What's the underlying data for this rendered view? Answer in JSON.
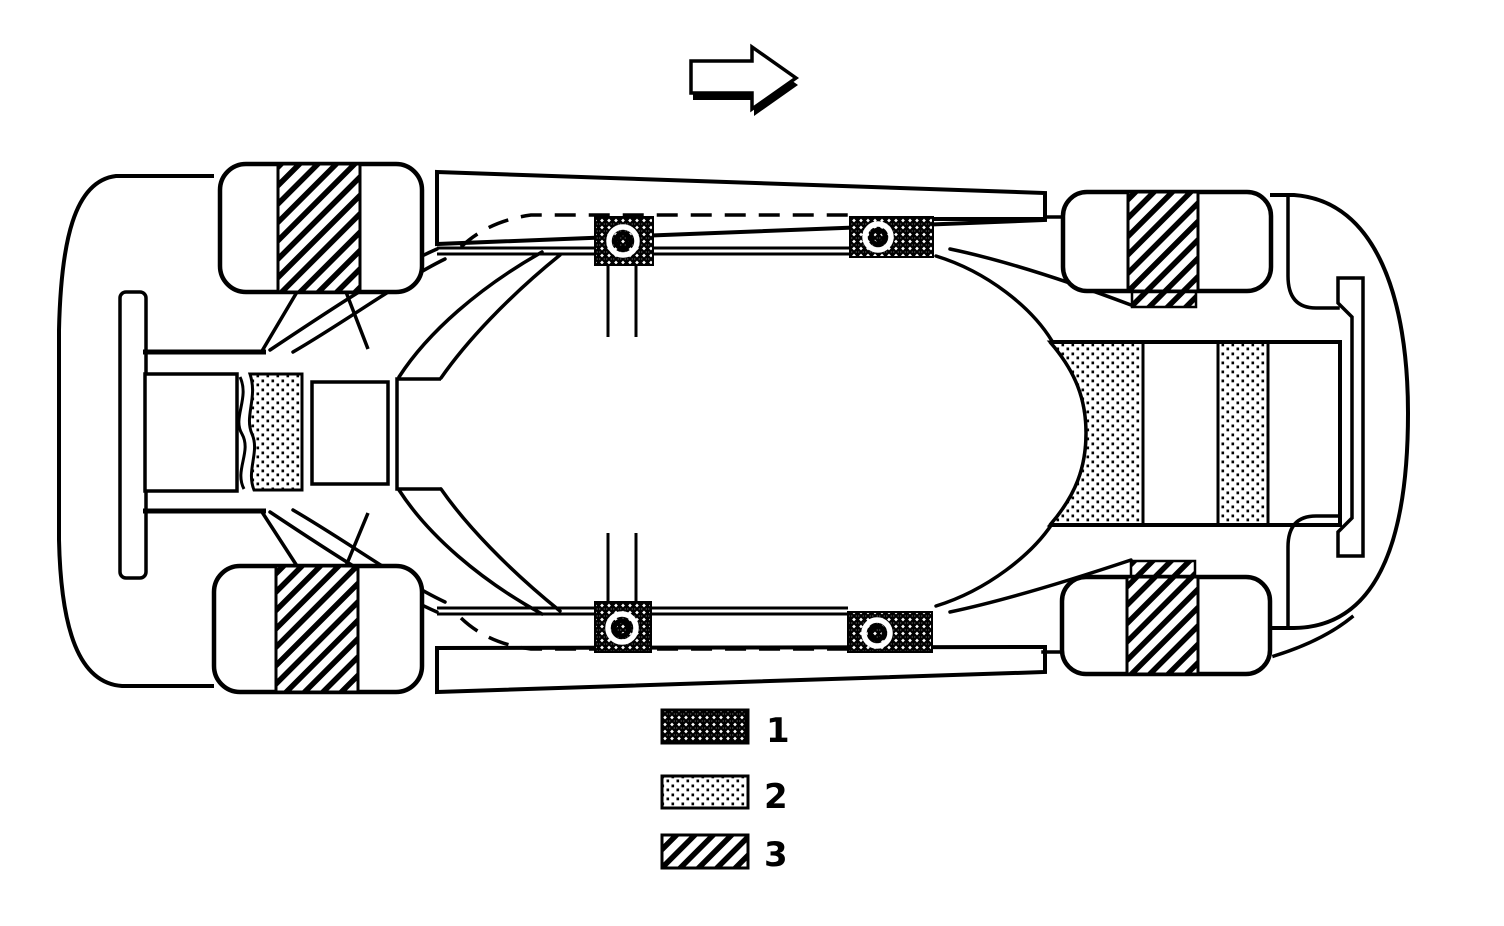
{
  "page": {
    "background": "#ffffff",
    "ink": "#000000",
    "kind": "technical line-art diagram, scanned look"
  },
  "diagram": {
    "subject": "car underbody / floorpan plan view with damping material zones",
    "direction_arrow": {
      "icon": "right-arrow-icon",
      "points": "right"
    },
    "wheels": [
      "rear-left",
      "front-right-top",
      "rear-left-bottom",
      "front-right-bottom"
    ],
    "legend": {
      "items": [
        {
          "label": "1",
          "pattern": "dense-stipple"
        },
        {
          "label": "2",
          "pattern": "dot-stipple"
        },
        {
          "label": "3",
          "pattern": "diagonal-hatch"
        }
      ]
    }
  }
}
